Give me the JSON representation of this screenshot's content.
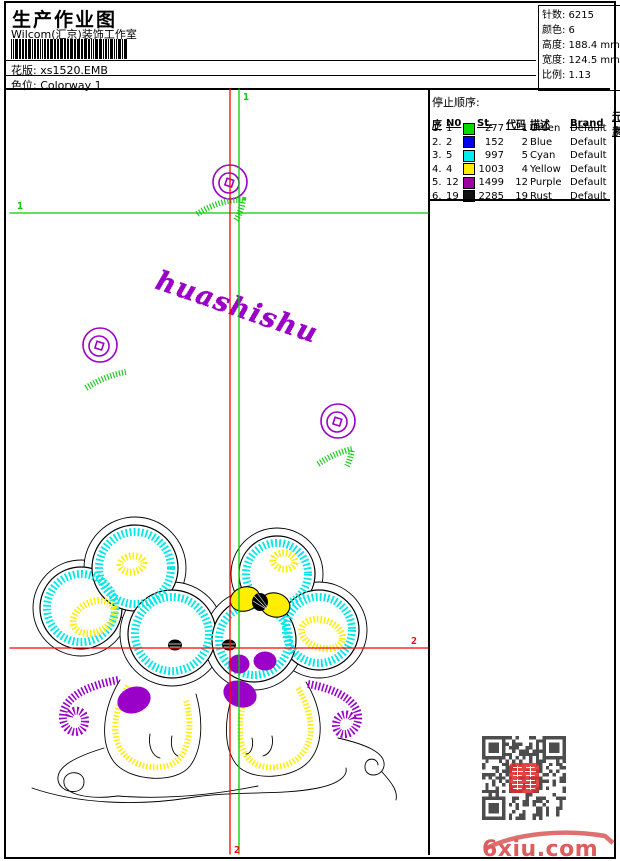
{
  "header": {
    "title": "生产作业图",
    "subtitle": "Wilcom(汇京)装饰工作室",
    "pattern": {
      "label": "花版",
      "value": "xs1520.EMB"
    },
    "colorway": {
      "label": "色位",
      "value": "Colorway 1"
    }
  },
  "stats": {
    "items": [
      {
        "label": "针数",
        "value": "6215"
      },
      {
        "label": "颜色",
        "value": "6"
      },
      {
        "label": "高度",
        "value": "188.4 mm"
      },
      {
        "label": "宽度",
        "value": "124.5 mm"
      },
      {
        "label": "比例",
        "value": "1.13"
      }
    ]
  },
  "stop_sequence": {
    "title": "停止顺序:",
    "columns": {
      "seq": "序",
      "n0": "N0",
      "st": "St.",
      "code": "代码",
      "desc": "描述",
      "brand": "Brand",
      "elem": "元素"
    },
    "rows": [
      {
        "seq": "1.",
        "n0": "1",
        "color": "#00dd00",
        "st": "277",
        "code": "1",
        "desc": "Green",
        "brand": "Default"
      },
      {
        "seq": "2.",
        "n0": "2",
        "color": "#0000ee",
        "st": "152",
        "code": "2",
        "desc": "Blue",
        "brand": "Default"
      },
      {
        "seq": "3.",
        "n0": "5",
        "color": "#00eeee",
        "st": "997",
        "code": "5",
        "desc": "Cyan",
        "brand": "Default"
      },
      {
        "seq": "4.",
        "n0": "4",
        "color": "#ffee00",
        "st": "1003",
        "code": "4",
        "desc": "Yellow",
        "brand": "Default"
      },
      {
        "seq": "5.",
        "n0": "12",
        "color": "#a000a0",
        "st": "1499",
        "code": "12",
        "desc": "Purple",
        "brand": "Default"
      },
      {
        "seq": "6.",
        "n0": "19",
        "color": "#101010",
        "st": "2285",
        "code": "19",
        "desc": "Rust",
        "brand": "Default"
      }
    ]
  },
  "design": {
    "script_text": "huashishu",
    "guide_labels": {
      "top": "1",
      "left": "1",
      "right": "2",
      "bottom": "2"
    },
    "colors": {
      "guide_green": "#00cc00",
      "guide_red": "#ff0000",
      "purple": "#9a00c8",
      "cyan": "#00e8e8",
      "yellow": "#ffee00",
      "leaf_green": "#1ecc1e"
    }
  },
  "watermark": {
    "text": "6xiu.com",
    "color": "#dd5c5c"
  }
}
